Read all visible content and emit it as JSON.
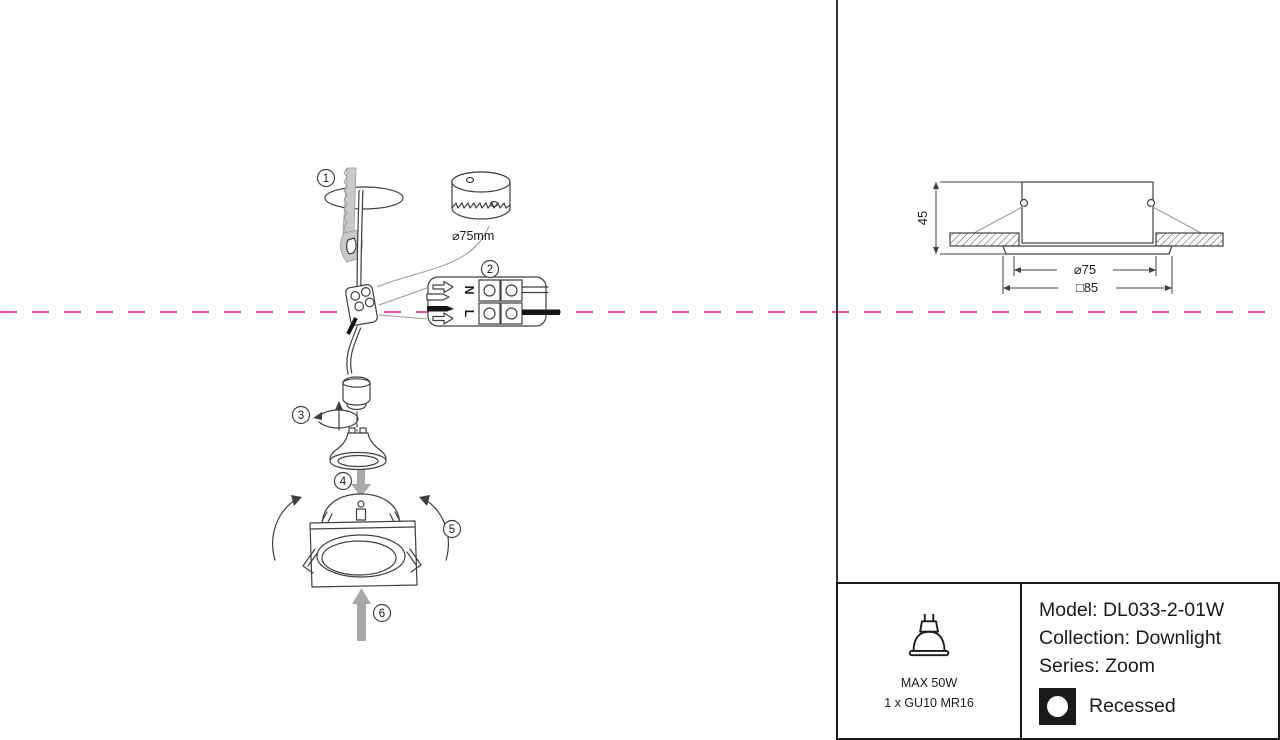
{
  "page": {
    "type": "downlight-installation-datasheet"
  },
  "steps": [
    "1",
    "2",
    "3",
    "4",
    "5",
    "6"
  ],
  "installation": {
    "hole_size_label": "⌀75mm",
    "terminal_neutral": "N",
    "terminal_live": "L"
  },
  "dimension_drawing": {
    "height": "45",
    "cutout_diameter": "⌀75",
    "outer_square": "□85"
  },
  "spec_panel": {
    "max_power": "MAX 50W",
    "lamp": "1 x GU10 MR16",
    "model": "Model: DL033-2-01W",
    "collection": "Collection: Downlight",
    "series": "Series: Zoom",
    "mounting": "Recessed"
  },
  "colors": {
    "line_art": "#404040",
    "centerline_pink": "#EC4F9E",
    "arrow_gray": "#A8A8A8",
    "panel_border": "#1a1a1a"
  },
  "icons": {
    "lamp_icon": "gu10-mr16-bulb-icon",
    "mounting_icon": "recessed-circle-icon"
  }
}
